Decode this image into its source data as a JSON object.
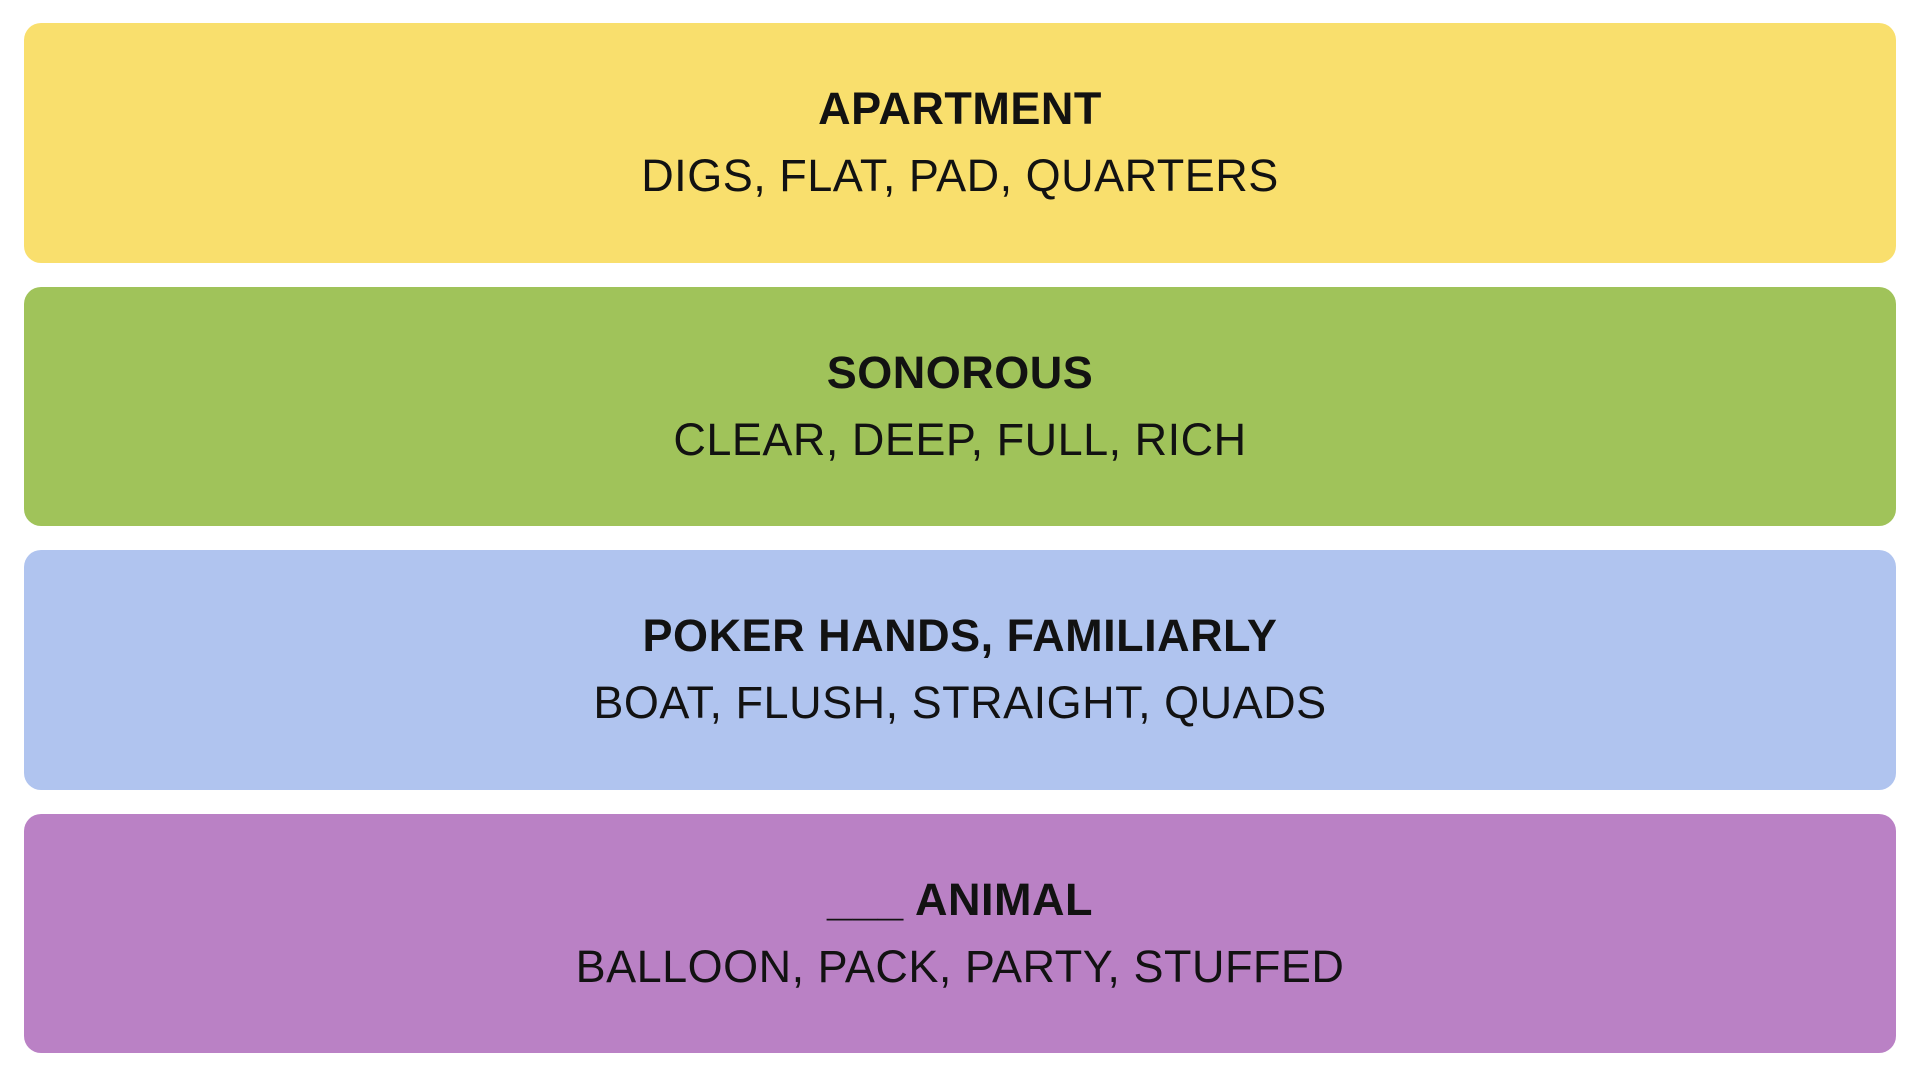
{
  "board": {
    "background_color": "#FFFFFF",
    "text_color": "#121212",
    "groups": [
      {
        "name": "yellow",
        "title": "APARTMENT",
        "words": "DIGS, FLAT, PAD, QUARTERS",
        "color": "#F9DF6D"
      },
      {
        "name": "green",
        "title": "SONOROUS",
        "words": "CLEAR, DEEP, FULL, RICH",
        "color": "#A0C35A"
      },
      {
        "name": "blue",
        "title": "POKER HANDS, FAMILIARLY",
        "words": "BOAT, FLUSH, STRAIGHT, QUADS",
        "color": "#B0C4EF"
      },
      {
        "name": "purple",
        "title": "___ ANIMAL",
        "words": "BALLOON, PACK, PARTY, STUFFED",
        "color": "#BA81C5"
      }
    ]
  }
}
